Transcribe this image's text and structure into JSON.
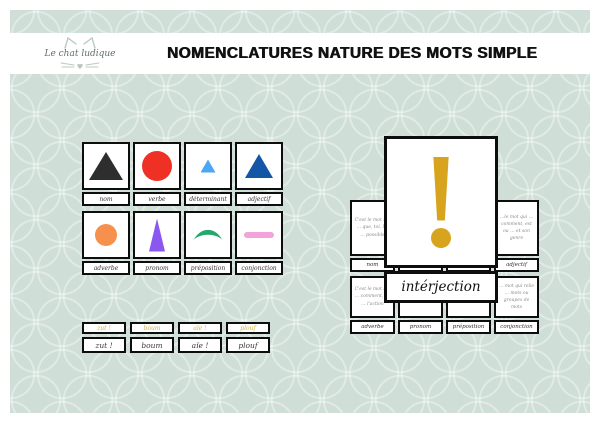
{
  "header": {
    "logo_text": "Le chat ludique",
    "title": "NOMENCLATURES NATURE DES MOTS SIMPLE"
  },
  "symbol_cards": [
    {
      "label": "nom",
      "shape": "large-black-triangle",
      "color": "#2e2e2e"
    },
    {
      "label": "verbe",
      "shape": "red-circle",
      "color": "#ee3124"
    },
    {
      "label": "déterminant",
      "shape": "small-lightblue-triangle",
      "color": "#4da6f5"
    },
    {
      "label": "adjectif",
      "shape": "darkblue-triangle",
      "color": "#1356a5"
    },
    {
      "label": "adverbe",
      "shape": "orange-circle",
      "color": "#f78f4d"
    },
    {
      "label": "pronom",
      "shape": "tall-violet-triangle",
      "color": "#8a57f0"
    },
    {
      "label": "préposition",
      "shape": "green-crescent",
      "color": "#22a96a"
    },
    {
      "label": "conjonction",
      "shape": "pink-bar",
      "color": "#f2a3dc"
    }
  ],
  "definition_board": {
    "big_card": {
      "label": "intérjection",
      "symbol": "exclamation-mark",
      "color": "#d8a41d"
    },
    "top_row": [
      {
        "label": "nom",
        "text": "C'est le mot qui … que, toi, lui … possible"
      },
      {
        "label": "adjectif",
        "text": "…le mot qui … comment, est ou … et son genre"
      }
    ],
    "bottom_row": [
      {
        "label": "adverbe",
        "text": "C'est le mot qui … comment, où … l'action"
      },
      {
        "label": "pronom",
        "text": "…"
      },
      {
        "label": "préposition",
        "text": "… le groupe de mots"
      },
      {
        "label": "conjonction",
        "text": "… mot qui relie … mots ou groupes de mots"
      }
    ]
  },
  "word_strips": {
    "gold_color": "#d4b44a",
    "gold_row": [
      "zut !",
      "boum",
      "aïe !",
      "plouf"
    ],
    "black_row": [
      "zut !",
      "boum",
      "aïe !",
      "plouf"
    ]
  }
}
